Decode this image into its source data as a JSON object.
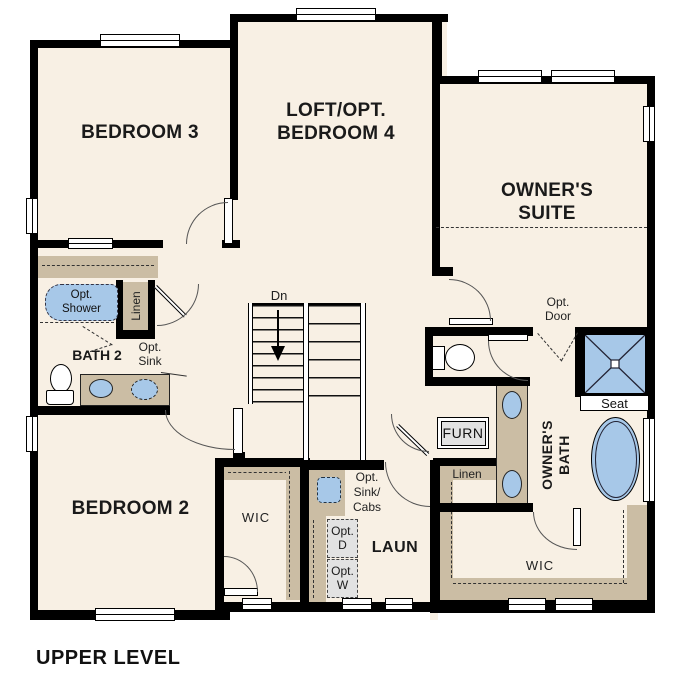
{
  "title": "UPPER LEVEL",
  "rooms": {
    "bedroom3": "BEDROOM 3",
    "loft": {
      "line1": "LOFT/OPT.",
      "line2": "BEDROOM 4"
    },
    "owners_suite": {
      "line1": "OWNER'S",
      "line2": "SUITE"
    },
    "bedroom2": "BEDROOM 2",
    "bath2": "BATH 2",
    "laundry": "LAUN",
    "owners_bath": {
      "line1": "OWNER'S",
      "line2": "BATH"
    },
    "wic_center": "WIC",
    "wic_owners": "WIC"
  },
  "labels": {
    "stairs_down": "Dn",
    "opt_shower": {
      "line1": "Opt.",
      "line2": "Shower"
    },
    "linen_bath2": "Linen",
    "opt_sink": {
      "line1": "Opt.",
      "line2": "Sink"
    },
    "opt_door": {
      "line1": "Opt.",
      "line2": "Door"
    },
    "seat": "Seat",
    "furnace": "FURN",
    "linen_owners": "Linen",
    "opt_sink_cabs": {
      "line1": "Opt.",
      "line2": "Sink/",
      "line3": "Cabs"
    },
    "opt_dryer": {
      "line1": "Opt.",
      "line2": "D"
    },
    "opt_washer": {
      "line1": "Opt.",
      "line2": "W"
    }
  },
  "colors": {
    "floor": "#f8f0e4",
    "wall": "#000000",
    "casework": "#cbbda4",
    "fixture_blue": "#a7c8e8",
    "appliance_gray": "#e2e2e2",
    "background": "#ffffff"
  }
}
